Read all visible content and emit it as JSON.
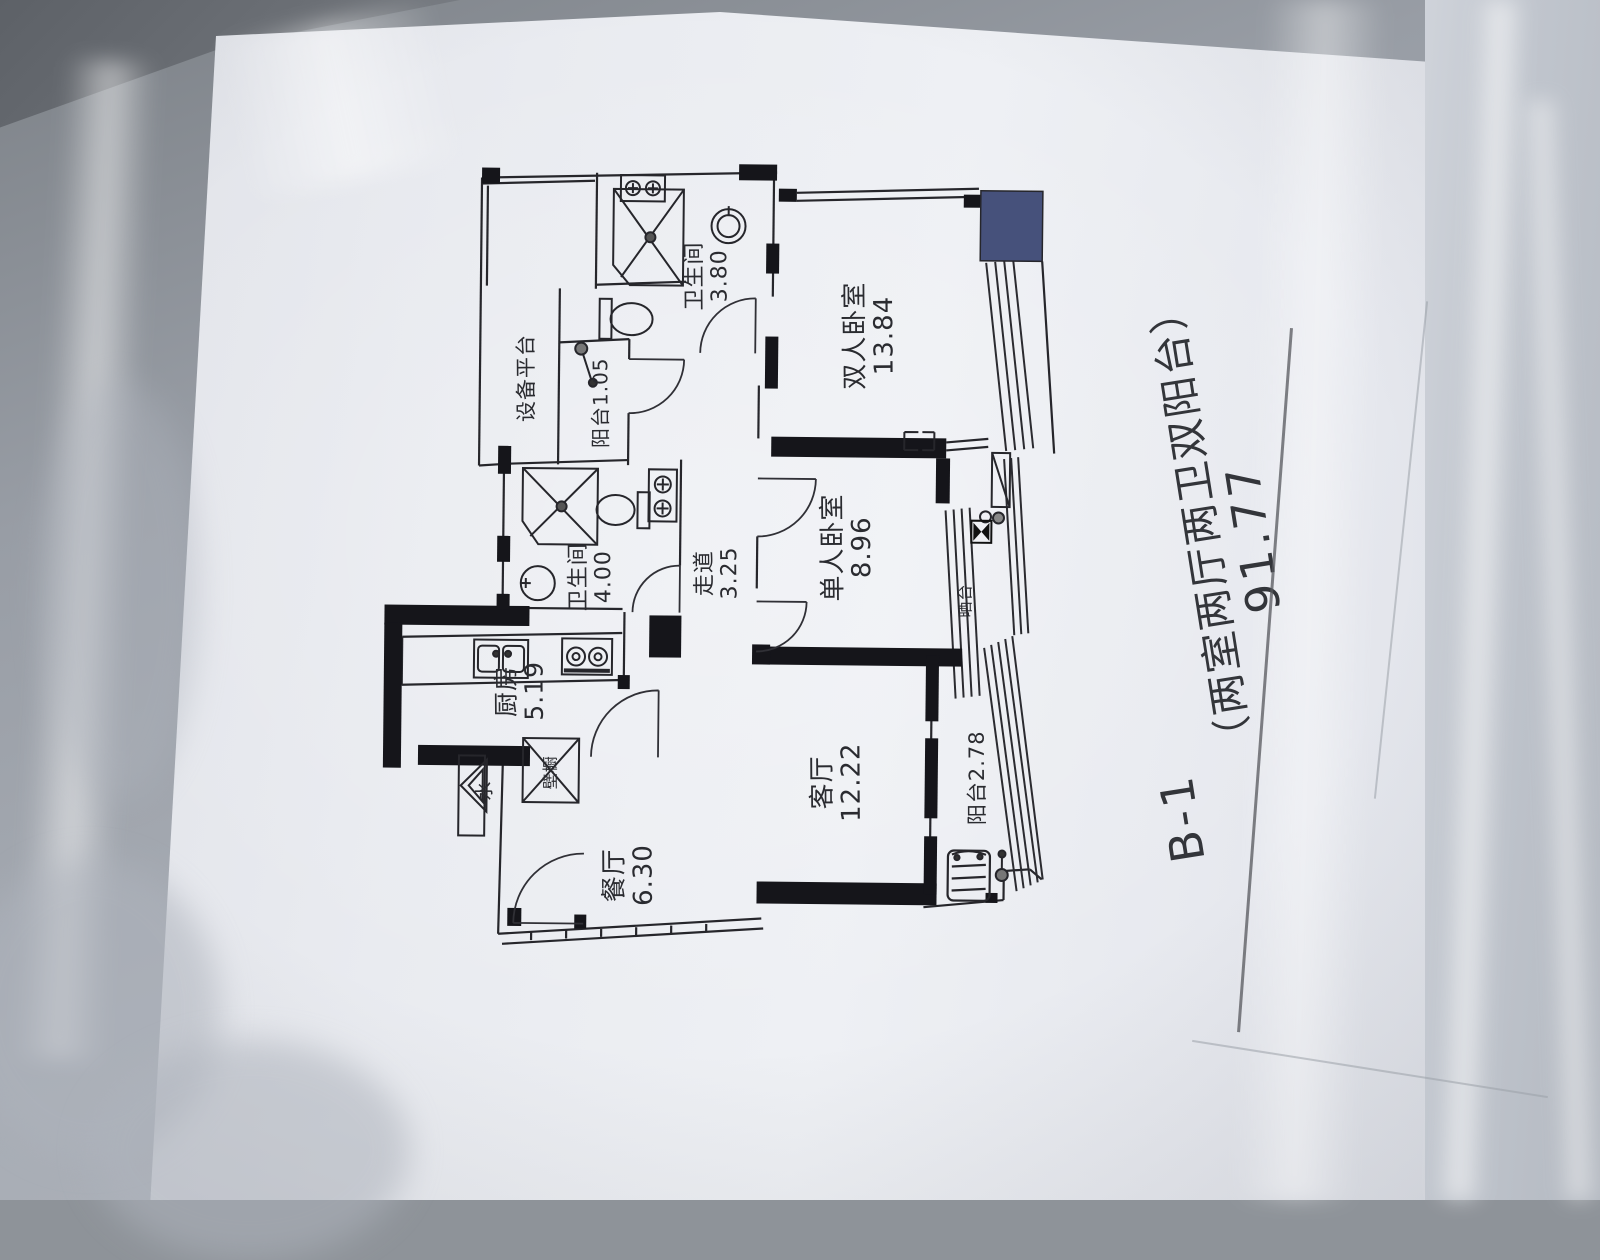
{
  "title": {
    "unit": "B-1",
    "spec": "（两室两厅两卫双阳台）",
    "total_area": "91.77"
  },
  "rooms": [
    {
      "name": "双人卧室",
      "area": "13.84"
    },
    {
      "name": "单人卧室",
      "area": "8.96"
    },
    {
      "name": "客厅",
      "area": "12.22"
    },
    {
      "name": "餐厅",
      "area": "6.30"
    },
    {
      "name": "厨房",
      "area": "5.19"
    },
    {
      "name": "卫生间",
      "area": "4.00"
    },
    {
      "name": "卫生间",
      "area": "3.80"
    },
    {
      "name": "走道",
      "area": "3.25"
    },
    {
      "name": "阳台",
      "area": "2.78"
    },
    {
      "name": "阳台",
      "area": "1.05"
    },
    {
      "name": "设备平台",
      "area": ""
    },
    {
      "name": "壁橱",
      "area": ""
    },
    {
      "name": "晒台",
      "area": ""
    },
    {
      "name": "水",
      "area": ""
    }
  ],
  "colors": {
    "ink": "#26262b",
    "column_block": "#46517b",
    "paper": "#e9ebf0"
  }
}
